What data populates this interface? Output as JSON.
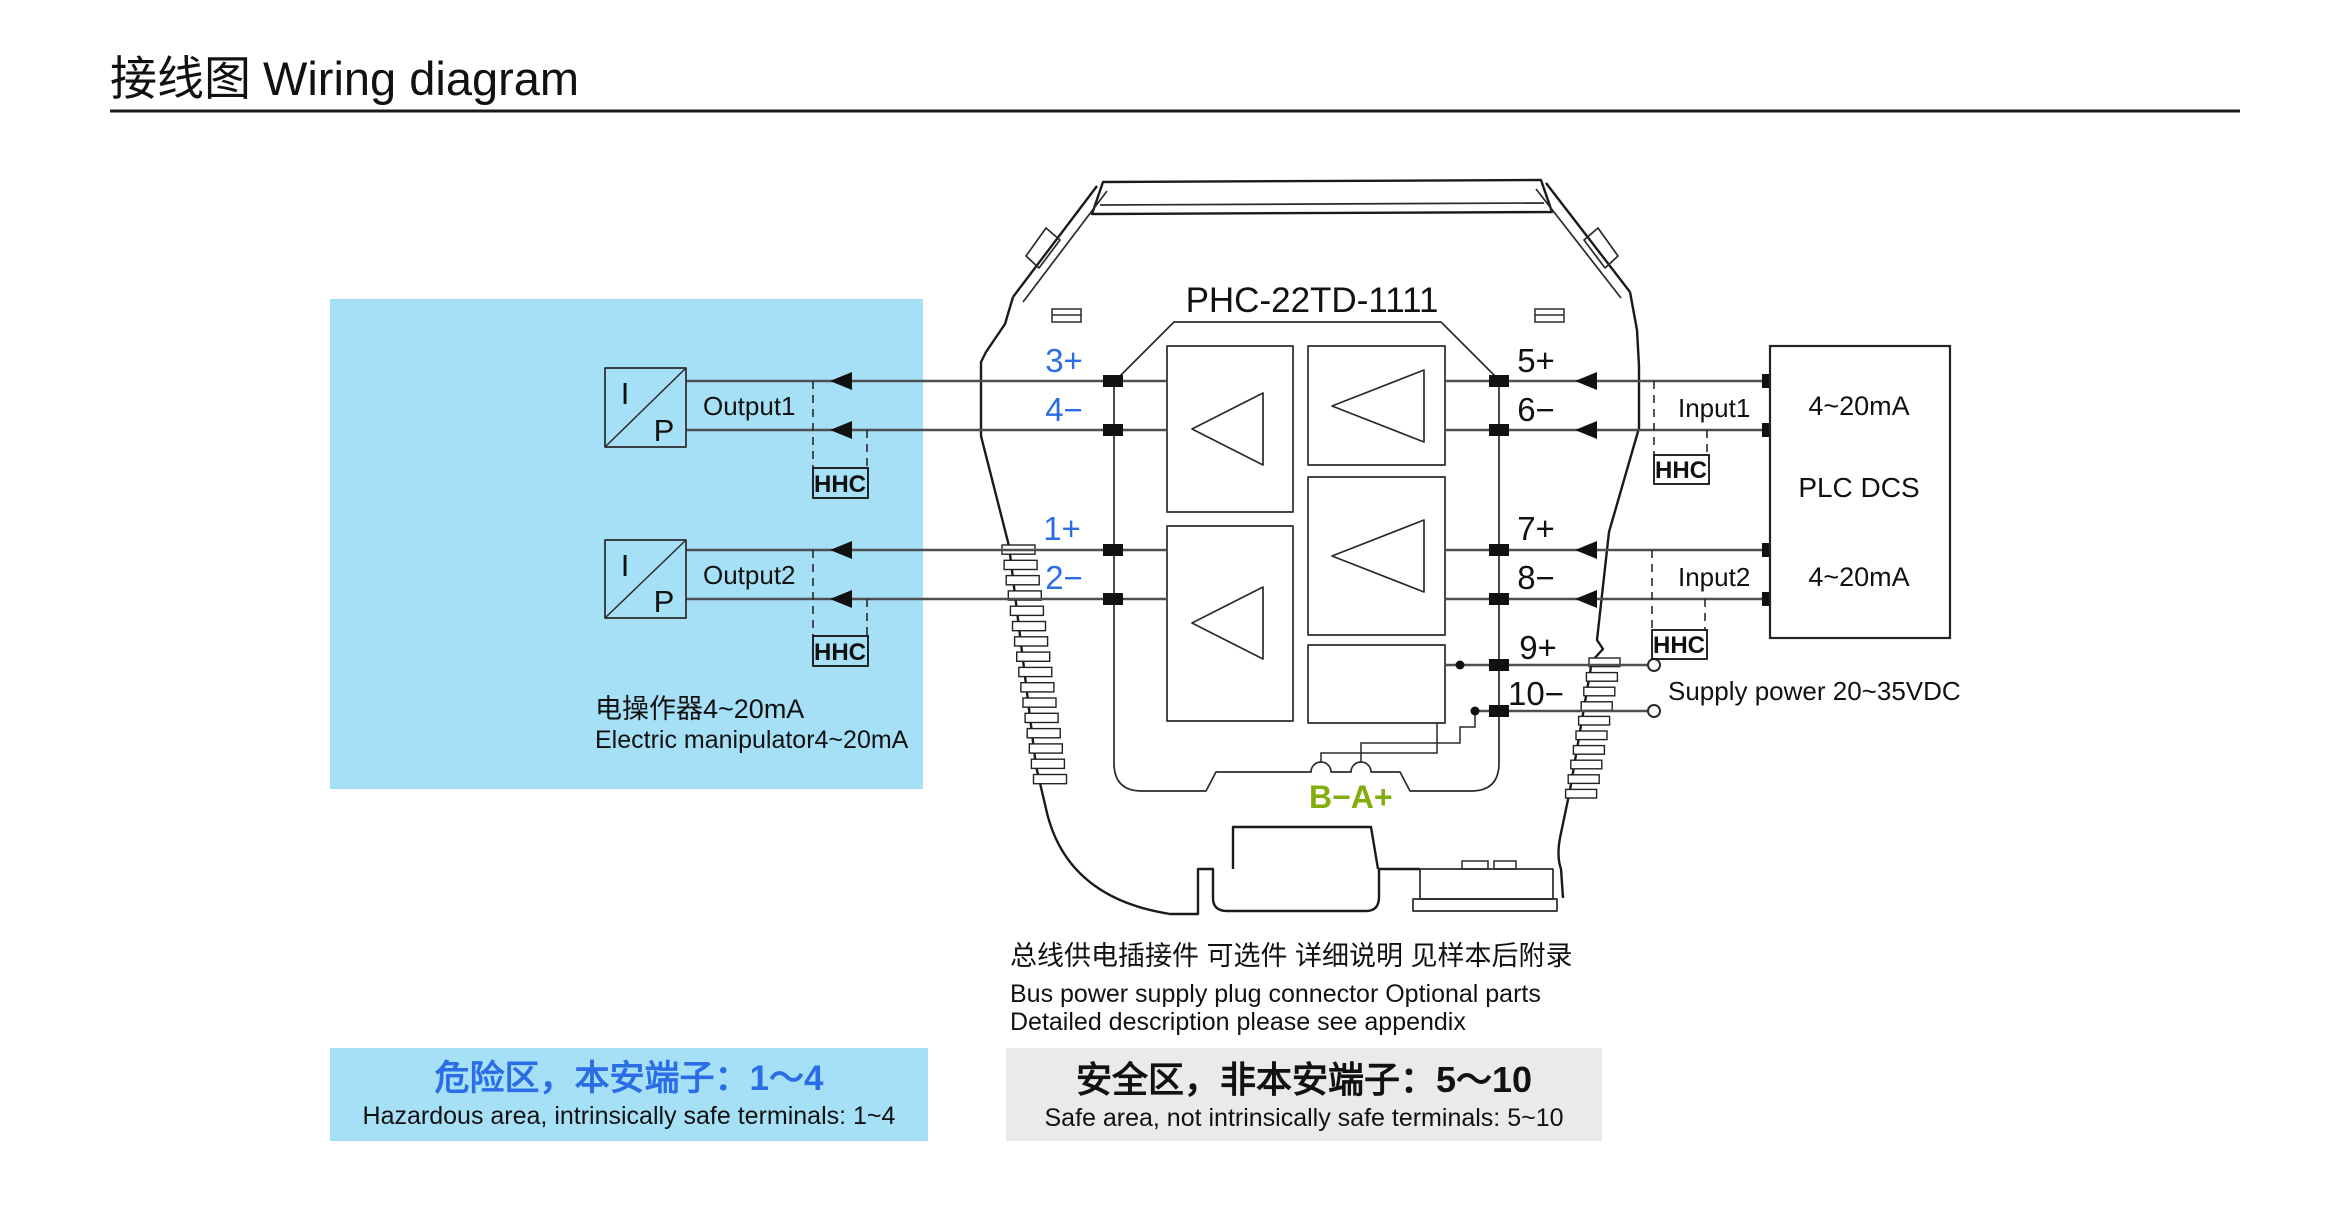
{
  "title": {
    "zh": "接线图",
    "en": "Wiring diagram"
  },
  "device": {
    "model": "PHC-22TD-1111",
    "bus_label": "B−A+"
  },
  "terminals": {
    "left": [
      "3+",
      "4−",
      "1+",
      "2−"
    ],
    "right": [
      "5+",
      "6−",
      "7+",
      "8−",
      "9+",
      "10−"
    ]
  },
  "left_area": {
    "ip_letter_top": "I",
    "ip_letter_bottom": "P",
    "output1": "Output1",
    "output2": "Output2",
    "hhc": "HHC",
    "caption_zh": "电操作器4~20mA",
    "caption_en": "Electric manipulator4~20mA"
  },
  "right_area": {
    "input1": "Input1",
    "input2": "Input2",
    "range1": "4~20mA",
    "range2": "4~20mA",
    "plc": "PLC  DCS",
    "hhc": "HHC",
    "supply": "Supply power 20~35VDC"
  },
  "notes": {
    "zh": "总线供电插接件 可选件 详细说明 见样本后附录",
    "en1": "Bus power supply plug connector  Optional parts",
    "en2": "Detailed description please see appendix"
  },
  "zones": {
    "hazardous": {
      "zh": "危险区，本安端子：1～4",
      "en": "Hazardous area, intrinsically safe terminals: 1~4"
    },
    "safe": {
      "zh": "安全区，非本安端子：5～10",
      "en": "Safe area, not intrinsically safe terminals: 5~10"
    }
  },
  "colors": {
    "area_blue": "#a6e0f6",
    "zone_gray": "#e9ebe8",
    "label_blue": "#2b6de5",
    "bus_green": "#82af0d",
    "wire": "#4d4f52"
  }
}
